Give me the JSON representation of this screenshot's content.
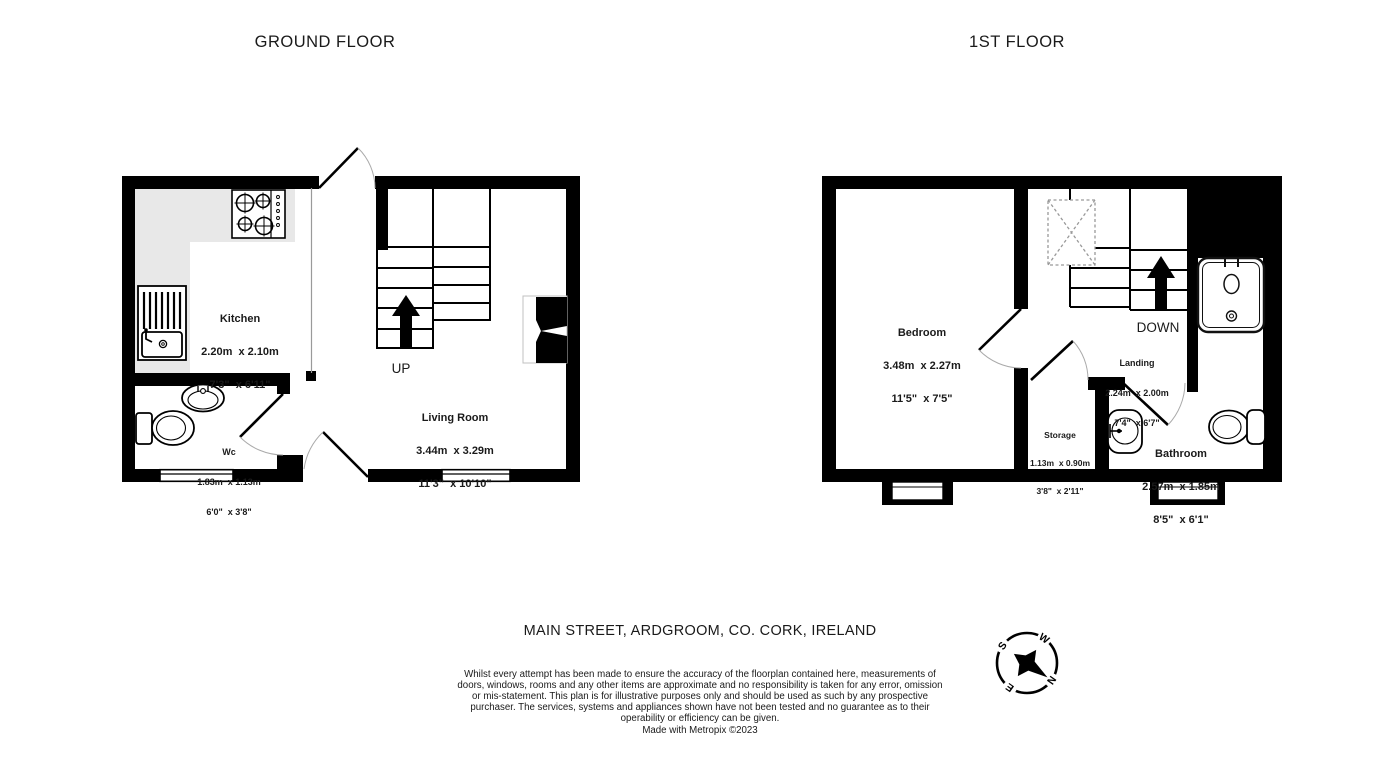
{
  "floors": [
    {
      "title": "GROUND FLOOR",
      "stairs_label": "UP",
      "rooms": [
        {
          "name": "Kitchen",
          "metric": "2.20m  x 2.10m",
          "imperial": "7'3\"  x 6'11\""
        },
        {
          "name": "Wc",
          "metric": "1.83m  x 1.13m",
          "imperial": "6'0\"  x 3'8\""
        },
        {
          "name": "Living Room",
          "metric": "3.44m  x 3.29m",
          "imperial": "11'3\"  x 10'10\""
        }
      ]
    },
    {
      "title": "1ST FLOOR",
      "stairs_label": "DOWN",
      "rooms": [
        {
          "name": "Bedroom",
          "metric": "3.48m  x 2.27m",
          "imperial": "11'5\"  x 7'5\""
        },
        {
          "name": "Landing",
          "metric": "2.24m  x 2.00m",
          "imperial": "7'4\"  x 6'7\""
        },
        {
          "name": "Storage",
          "metric": "1.13m  x 0.90m",
          "imperial": "3'8\"  x 2'11\""
        },
        {
          "name": "Bathroom",
          "metric": "2.57m  x 1.85m",
          "imperial": "8'5\"  x 6'1\""
        }
      ]
    }
  ],
  "address": "MAIN STREET, ARDGROOM, CO. CORK, IRELAND",
  "disclaimer": "Whilst every attempt has been made to ensure the accuracy of the floorplan contained here, measurements of doors, windows, rooms and any other items are approximate and no responsibility is taken for any error, omission or mis-statement. This plan is for illustrative purposes only and should be used as such by any prospective purchaser. The services, systems and appliances shown have not been tested and no guarantee as to their operability or efficiency can be given.",
  "credit": "Made with Metropix ©2023",
  "compass": {
    "n": "N",
    "e": "E",
    "s": "S",
    "w": "W"
  },
  "colors": {
    "wall": "#000000",
    "counter": "#e8e8e8",
    "background": "#ffffff"
  }
}
